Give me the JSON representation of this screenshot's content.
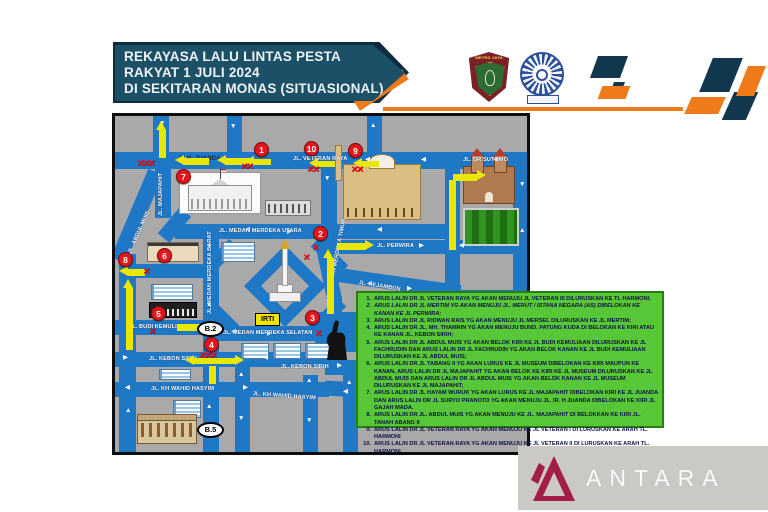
{
  "banner": {
    "line1": "REKAYASA LALU LINTAS PESTA",
    "line2": "RAKYAT 1 JULI 2024",
    "line3": "DI SEKITARAN MONAS (SITUASIONAL)"
  },
  "logos": {
    "metro_text": "METRO JAYA"
  },
  "map": {
    "streets": [
      {
        "label": "IR H. JUANDA"
      },
      {
        "label": "JL. VETERAN RAYA"
      },
      {
        "label": "JL. DR SUTOMO"
      },
      {
        "label": "JL. MEDAN MERDEKA UTARA"
      },
      {
        "label": "JL. PERWIRA"
      },
      {
        "label": "JL. PEJAMBON"
      },
      {
        "label": "JL. MEDAN MERDEKA BARAT"
      },
      {
        "label": "JL. MEDAN MERDEKA TIMUR"
      },
      {
        "label": "JL. MAJAPAHIT"
      },
      {
        "label": "JL. ABDUL MUIS"
      },
      {
        "label": "JL. MEDAN MERDEKA SELATAN"
      },
      {
        "label": "JL. BUDI KEMULIAAN"
      },
      {
        "label": "JL. KEBON SIRIH"
      },
      {
        "label": "JL. KEBON SIRIH"
      },
      {
        "label": "JL. KH WAHID HASYIM"
      },
      {
        "label": "JL. KH WAHID HASYIM"
      }
    ],
    "badges": [
      "1",
      "2",
      "3",
      "4",
      "5",
      "6",
      "7",
      "8",
      "9",
      "10"
    ],
    "ovals": [
      "B.2",
      "B.5"
    ],
    "irti_label": "IRTI"
  },
  "legend": {
    "items": [
      {
        "num": "1.",
        "text": "ARUS LALIN DR JL VETERAN RAYA YG AKAN MENUJU JL VETERAN III DILURUSKAN KE TL HARMONI;"
      },
      {
        "num": "2.",
        "text": "ARUS LALIN DR JL MERTIM YG AKAN MENUJU JL. MERUT / ISTANA NEGARA (AS) DIBELOKAN KE KANAN KE JL PERWIRA;"
      },
      {
        "num": "3.",
        "text": "ARUS LALIN DR JL RIDWAN RAIS YG AKAN MENUJU JL MERSEL DILURUSKAN KE JL MERTIM;"
      },
      {
        "num": "4.",
        "text": "ARUS LALIN DR JL. MH. THAMRIN YG AKAN MENUJU BUND. PATUNG KUDA DI BELOKAN KE KIRI ATAU KE KANAN JL. KEBON SIRIH;"
      },
      {
        "num": "5.",
        "text": "ARUS LALIN DR JL ABDUL MUIS YG AKAN BELOK KIRI KE JL BUDI KEMULIAAN DILURUSKAN KE JL FACHRUDIN DAN ARUS LALIN DR JL FACHRUDIN YG AKAN BELOK KANAN KE JL BUDI KEMULIAAN DILURUSKAN KE JL ABDUL MUIS;"
      },
      {
        "num": "6.",
        "text": "ARUS LALIN DR JL TABANG II YG AKAN LURUS KE JL MUSEUM DIBELOKAN KE KIRI MAUPUN KE KANAN, ARUS LALIN DR JL MAJAPAHIT YG AKAN BELOK KE KIRI KE JL MUSEUM DILURUSKAN KE JL ABDUL MUIS DAN ARUS LALIN DR JL ABDUL MUIS YG AKAN BELOK KANAN KE JL MUSEUM DILURUSKAN KE JL MAJAPAHIT;"
      },
      {
        "num": "7.",
        "text": "ARUS LALIN DR JL HAYAM WURUK YG AKAN LURUS KE JL MAJAPAHIT DIBELOKAN KIRI KE JL JUANDA DAN ARUS LALIN DR JL SURYO PRANOTO YG AKAN MENUJU JL. IR. H JUANDA DIBELOKAN KE KIRI JL GAJAH MADA."
      },
      {
        "num": "8.",
        "text": "ARUS LALIN DR JL. ABDUL MUIS YG AKAN MENUJU KE JL. MAJAPAHIT DI BELOKKAN KE KIRI JL. TANAH ABANG II"
      },
      {
        "num": "9.",
        "text": "ARUS LALIN DR JL VETERAN RAYA YG AKAN MENUJU KE JL VETERAN I DI LURUSKAN KE ARAH TL. HARMONI"
      },
      {
        "num": "10.",
        "text": "ARUS LALIN DR JL VETERAN RAYA YG AKAN MENUJU KE JL VETERAN II DI LURUSKAN KE ARAH TL. HARMONI"
      }
    ]
  },
  "watermark": {
    "text": "ANTARA"
  },
  "colors": {
    "banner_bg": "#1b5066",
    "accent_orange": "#ee7a1a",
    "deco_navy": "#10374e",
    "road_blue": "#1e78c6",
    "map_bg": "#a9a9a9",
    "legend_green": "#57c637",
    "badge_red": "#e3161c",
    "irti_yellow": "#f2e400",
    "antara_maroon": "#a31e45"
  }
}
